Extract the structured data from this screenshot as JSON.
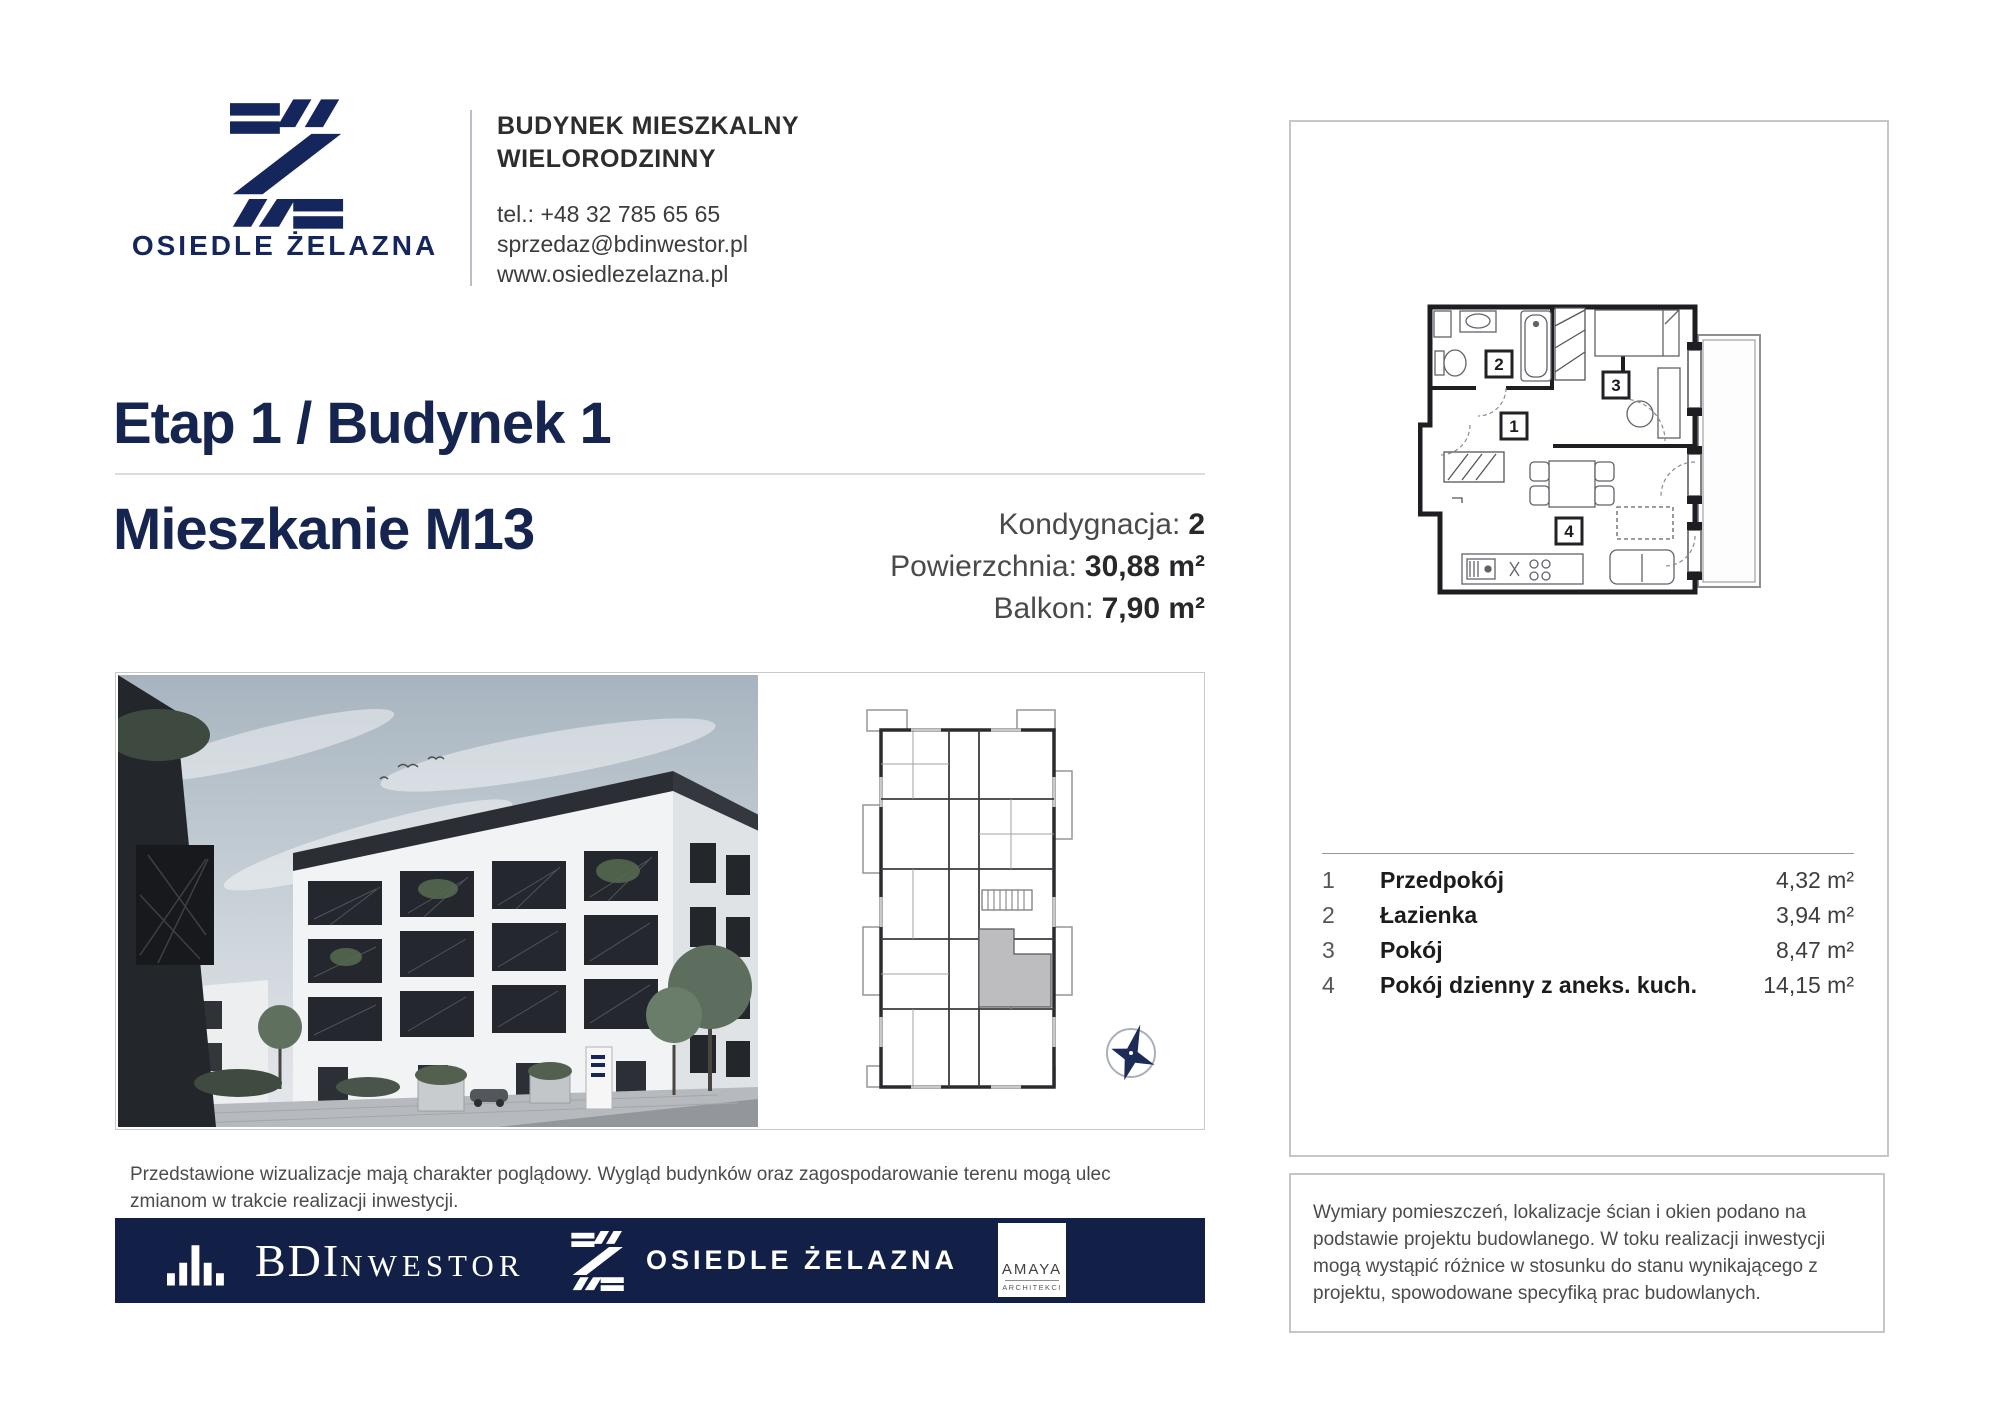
{
  "header": {
    "brand_name": "OSIEDLE ŻELAZNA",
    "building_type_line1": "BUDYNEK MIESZKALNY",
    "building_type_line2": "WIELORODZINNY",
    "phone": "tel.: +48 32 785 65 65",
    "email": "sprzedaz@bdinwestor.pl",
    "website": "www.osiedlezelazna.pl"
  },
  "title": {
    "stage": "Etap 1 / Budynek 1",
    "apartment": "Mieszkanie M13"
  },
  "summary": {
    "floor_label": "Kondygnacja:",
    "floor_value": "2",
    "area_label": "Powierzchnia:",
    "area_value": "30,88 m²",
    "balcony_label": "Balkon:",
    "balcony_value": "7,90 m²"
  },
  "rooms": [
    {
      "no": "1",
      "name": "Przedpokój",
      "area": "4,32 m²"
    },
    {
      "no": "2",
      "name": "Łazienka",
      "area": "3,94 m²"
    },
    {
      "no": "3",
      "name": "Pokój",
      "area": "8,47 m²"
    },
    {
      "no": "4",
      "name": "Pokój dzienny z aneks. kuch.",
      "area": "14,15 m²"
    }
  ],
  "disclaimers": {
    "visualization": "Przedstawione wizualizacje mają charakter poglądowy. Wygląd budynków oraz zagospodarowanie terenu mogą ulec zmianom w trakcie realizacji inwestycji.",
    "dimensions": "Wymiary pomieszczeń, lokalizacje ścian i okien podano na podstawie projektu budowlanego. W toku realizacji inwestycji mogą wystąpić różnice w stosunku do stanu wynikającego z projektu, spowodowane specyfiką prac budowlanych."
  },
  "footer": {
    "developer_primary": "BDI",
    "developer_secondary": "NWESTOR",
    "estate": "OSIEDLE ŻELAZNA",
    "architect_name": "AMAYA",
    "architect_sub": "ARCHITEKCI"
  },
  "colors": {
    "brand_navy": "#14265c",
    "heading_navy": "#152550",
    "footer_navy": "#121f47",
    "highlight_unit_gray": "#bdbdc0",
    "border_gray": "#c6c6c6"
  }
}
